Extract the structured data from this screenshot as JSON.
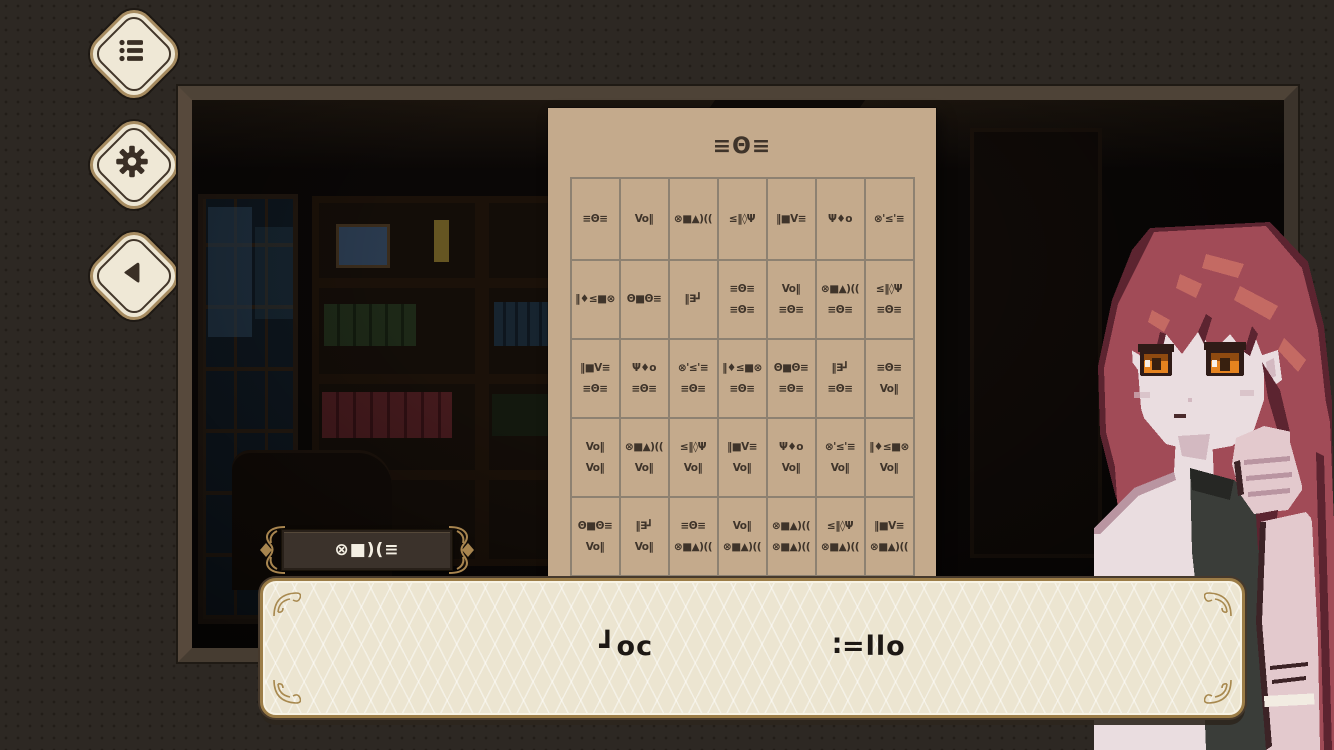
{
  "colors": {
    "gold_accent": "#a8894f",
    "paper": "#c4aa8c",
    "dialog_cream": "#ece5d1",
    "plate_dark": "#3b322b",
    "page_background": "#2d2823",
    "glyph_ink": "#3f342a"
  },
  "menu": {
    "buttons": [
      {
        "id": "log",
        "icon": "list-icon"
      },
      {
        "id": "settings",
        "icon": "gear-icon"
      },
      {
        "id": "back",
        "icon": "back-icon"
      }
    ]
  },
  "paper": {
    "title_glyph": "≡Θ≡",
    "table": {
      "columns": 7,
      "rows": [
        [
          [
            "≡Θ≡"
          ],
          [
            "Vo‖"
          ],
          [
            "⊗■▲)(("
          ],
          [
            "≤‖◊Ψ"
          ],
          [
            "‖■V≡"
          ],
          [
            "Ψ♦o"
          ],
          [
            "⊗'≤'≡"
          ]
        ],
        [
          [
            "‖♦≤■⊗"
          ],
          [
            "Θ■Θ≡"
          ],
          [
            "‖∃┛"
          ],
          [
            "≡Θ≡",
            "≡Θ≡"
          ],
          [
            "Vo‖",
            "≡Θ≡"
          ],
          [
            "⊗■▲)((",
            "≡Θ≡"
          ],
          [
            "≤‖◊Ψ",
            "≡Θ≡"
          ]
        ],
        [
          [
            "‖■V≡",
            "≡Θ≡"
          ],
          [
            "Ψ♦o",
            "≡Θ≡"
          ],
          [
            "⊗'≤'≡",
            "≡Θ≡"
          ],
          [
            "‖♦≤■⊗",
            "≡Θ≡"
          ],
          [
            "Θ■Θ≡",
            "≡Θ≡"
          ],
          [
            "‖∃┛",
            "≡Θ≡"
          ],
          [
            "≡Θ≡",
            "Vo‖"
          ]
        ],
        [
          [
            "Vo‖",
            "Vo‖"
          ],
          [
            "⊗■▲)((",
            "Vo‖"
          ],
          [
            "≤‖◊Ψ",
            "Vo‖"
          ],
          [
            "‖■V≡",
            "Vo‖"
          ],
          [
            "Ψ♦o",
            "Vo‖"
          ],
          [
            "⊗'≤'≡",
            "Vo‖"
          ],
          [
            "‖♦≤■⊗",
            "Vo‖"
          ]
        ],
        [
          [
            "Θ■Θ≡",
            "Vo‖"
          ],
          [
            "‖∃┛",
            "Vo‖"
          ],
          [
            "≡Θ≡",
            "⊗■▲)(("
          ],
          [
            "Vo‖",
            "⊗■▲)(("
          ],
          [
            "⊗■▲)((",
            "⊗■▲)(("
          ],
          [
            "≤‖◊Ψ",
            "⊗■▲)(("
          ],
          [
            "‖■V≡",
            "⊗■▲)(("
          ]
        ]
      ]
    }
  },
  "name_plate": {
    "name_glyph": "⊗■)(≡"
  },
  "dialogue": {
    "words": [
      "┛oc",
      "∶=llo"
    ]
  },
  "character": {
    "name": "red-haired-girl-pixel-portrait"
  }
}
